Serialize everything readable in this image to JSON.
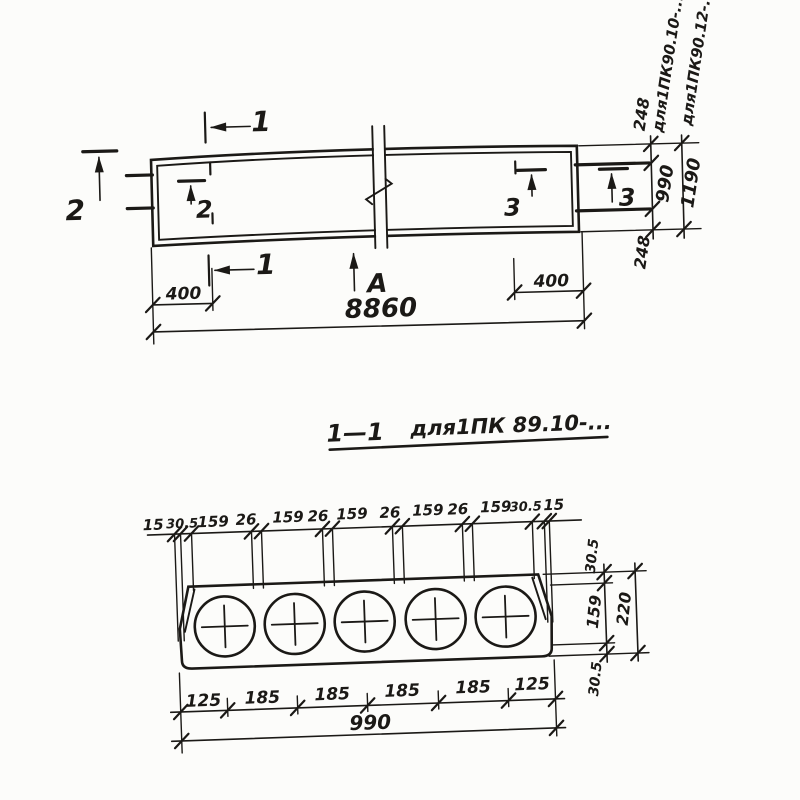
{
  "meta": {
    "ink_color": "#1b1916",
    "paper_color": "#fcfcfa"
  },
  "plan": {
    "marks": {
      "one": "1",
      "two": "2",
      "three": "3",
      "axis": "А"
    },
    "dims": {
      "end_left": "400",
      "end_right": "400",
      "length": "8860",
      "top_offset": "248",
      "width_990": "990",
      "bottom_offset": "248",
      "width_1190": "1190"
    },
    "notes": {
      "variant_10": "для1ПК90.10-...",
      "variant_12": "для1ПК90.12-..."
    }
  },
  "section": {
    "title": {
      "mark": "1—1",
      "label": "для1ПК 89.10-..."
    },
    "top_dims": [
      "15",
      "30.5",
      "159",
      "26",
      "159",
      "26",
      "159",
      "26",
      "159",
      "26",
      "159",
      "30.5",
      "15"
    ],
    "side_dims": {
      "top_cover": "30.5",
      "core_diameter": "159",
      "bottom_cover": "30.5",
      "height": "220"
    },
    "bottom_dims": [
      "125",
      "185",
      "185",
      "185",
      "185",
      "125"
    ],
    "bottom_total": "990"
  }
}
